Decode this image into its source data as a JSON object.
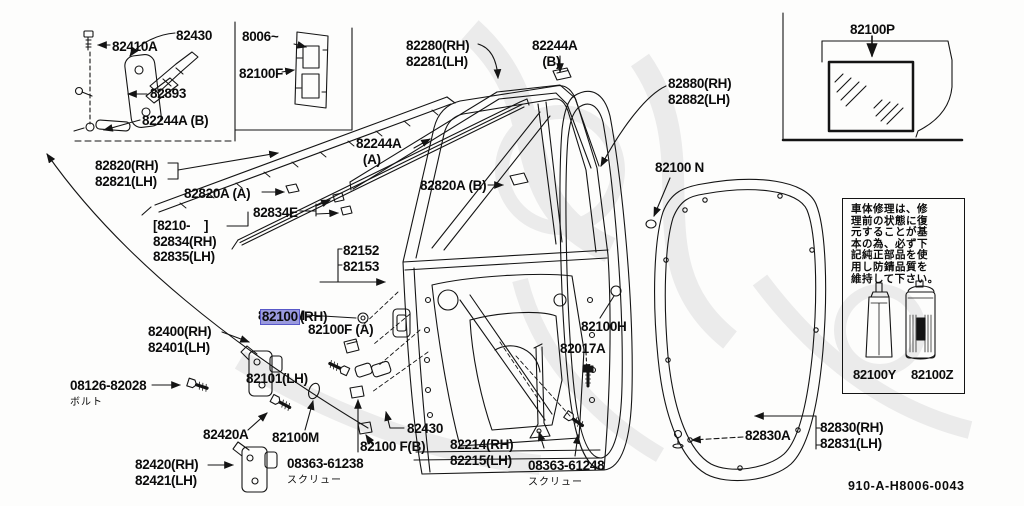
{
  "colors": {
    "line": "#141414",
    "highlight_fill": "#9a9ade",
    "highlight_border": "#5858c8",
    "watermark": "#ebebeb"
  },
  "highlight": {
    "part": "82100",
    "suffix": "(RH)",
    "line2": "82101(LH)",
    "x": 246,
    "y": 262
  },
  "labels": [
    {
      "id": "82430-box",
      "lines": [
        "82430"
      ],
      "x": 176,
      "y": 28
    },
    {
      "id": "82410A",
      "lines": [
        "82410A"
      ],
      "x": 112,
      "y": 39
    },
    {
      "id": "82893",
      "lines": [
        "82893"
      ],
      "x": 150,
      "y": 86
    },
    {
      "id": "82244A-B-box",
      "lines": [
        "82244A (B)"
      ],
      "x": 142,
      "y": 113
    },
    {
      "id": "8006",
      "lines": [
        "8006~"
      ],
      "x": 242,
      "y": 29
    },
    {
      "id": "82100F-box",
      "lines": [
        "82100F"
      ],
      "x": 239,
      "y": 66
    },
    {
      "id": "82280",
      "lines": [
        "82280(RH)",
        "82281(LH)"
      ],
      "x": 406,
      "y": 38
    },
    {
      "id": "82244A-B",
      "lines": [
        "82244A",
        "   (B)"
      ],
      "x": 532,
      "y": 38
    },
    {
      "id": "82880",
      "lines": [
        "82880(RH)",
        "82882(LH)"
      ],
      "x": 668,
      "y": 76
    },
    {
      "id": "82100N",
      "lines": [
        "82100 N"
      ],
      "x": 655,
      "y": 160
    },
    {
      "id": "82100P",
      "lines": [
        "82100P"
      ],
      "x": 850,
      "y": 22
    },
    {
      "id": "82820",
      "lines": [
        "82820(RH)",
        "82821(LH)"
      ],
      "x": 95,
      "y": 158
    },
    {
      "id": "82820A-A",
      "lines": [
        "82820A (A)"
      ],
      "x": 184,
      "y": 186
    },
    {
      "id": "82834E",
      "lines": [
        "82834E"
      ],
      "x": 253,
      "y": 205
    },
    {
      "id": "8210",
      "lines": [
        "[8210-    ]",
        "82834(RH)",
        "82835(LH)"
      ],
      "x": 153,
      "y": 218
    },
    {
      "id": "82152",
      "lines": [
        "82152",
        "82153"
      ],
      "x": 343,
      "y": 243
    },
    {
      "id": "82244A-A",
      "lines": [
        "82244A",
        "  (A)"
      ],
      "x": 356,
      "y": 136
    },
    {
      "id": "82820A-B",
      "lines": [
        "82820A (B)"
      ],
      "x": 420,
      "y": 178
    },
    {
      "id": "82100M-1",
      "lines": [
        "82100M"
      ],
      "x": 258,
      "y": 308
    },
    {
      "id": "82100F-A",
      "lines": [
        "82100F (A)"
      ],
      "x": 308,
      "y": 322
    },
    {
      "id": "82400",
      "lines": [
        "82400(RH)",
        "82401(LH)"
      ],
      "x": 148,
      "y": 324
    },
    {
      "id": "08126-82028",
      "lines": [
        "08126-82028"
      ],
      "sub": "ボルト",
      "x": 70,
      "y": 378
    },
    {
      "id": "82420A",
      "lines": [
        "82420A"
      ],
      "x": 203,
      "y": 427
    },
    {
      "id": "82100M-2",
      "lines": [
        "82100M"
      ],
      "x": 272,
      "y": 430
    },
    {
      "id": "82420",
      "lines": [
        "82420(RH)",
        "82421(LH)"
      ],
      "x": 135,
      "y": 457
    },
    {
      "id": "08363-61238",
      "lines": [
        "08363-61238"
      ],
      "sub": "スクリュー",
      "x": 287,
      "y": 456
    },
    {
      "id": "82430-2",
      "lines": [
        "82430"
      ],
      "x": 407,
      "y": 421
    },
    {
      "id": "82100F-B",
      "lines": [
        "82100 F(B)"
      ],
      "x": 360,
      "y": 439
    },
    {
      "id": "82214",
      "lines": [
        "82214(RH)",
        "82215(LH)"
      ],
      "x": 450,
      "y": 437
    },
    {
      "id": "08363-61248",
      "lines": [
        "08363-61248"
      ],
      "sub": "スクリュー",
      "x": 528,
      "y": 458
    },
    {
      "id": "82017A",
      "lines": [
        "82017A"
      ],
      "x": 560,
      "y": 341
    },
    {
      "id": "82100H",
      "lines": [
        "82100H"
      ],
      "x": 581,
      "y": 319
    },
    {
      "id": "82830A",
      "lines": [
        "82830A"
      ],
      "x": 745,
      "y": 428
    },
    {
      "id": "82830",
      "lines": [
        "82830(RH)",
        "82831(LH)"
      ],
      "x": 820,
      "y": 420
    }
  ],
  "note_box": {
    "x": 842,
    "y": 198,
    "w": 121,
    "h": 194,
    "lines": [
      "車体修理は、修",
      "理前の状態に復",
      "元することが基",
      "本の為、必ず下",
      "記純正部品を使",
      "用し防錆品質を",
      "維持して下さい。"
    ],
    "tube_label": "82100Y",
    "can_label": "82100Z"
  },
  "footer": {
    "code": "910-A-H8006-0043"
  }
}
